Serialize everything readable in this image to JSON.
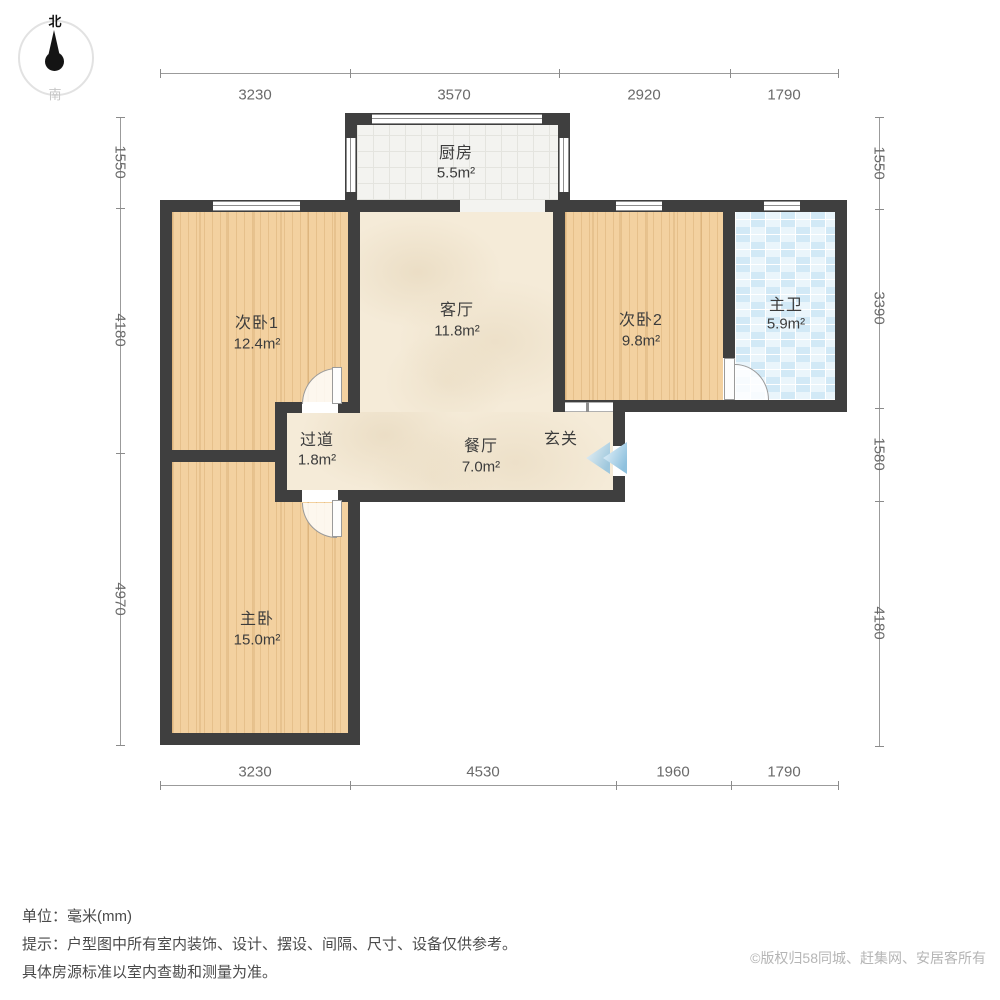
{
  "compass": {
    "north": "北",
    "south": "南"
  },
  "rooms": {
    "kitchen": {
      "name": "厨房",
      "area": "5.5m²"
    },
    "bedroom1": {
      "name": "次卧1",
      "area": "12.4m²"
    },
    "living": {
      "name": "客厅",
      "area": "11.8m²"
    },
    "bedroom2": {
      "name": "次卧2",
      "area": "9.8m²"
    },
    "bathroom": {
      "name": "主卫",
      "area": "5.9m²"
    },
    "hallway": {
      "name": "过道",
      "area": "1.8m²"
    },
    "dining": {
      "name": "餐厅",
      "area": "7.0m²"
    },
    "entry": {
      "name": "玄关"
    },
    "master": {
      "name": "主卧",
      "area": "15.0m²"
    }
  },
  "dimensions": {
    "top": [
      "3230",
      "3570",
      "2920",
      "1790"
    ],
    "bottom": [
      "3230",
      "4530",
      "1960",
      "1790"
    ],
    "left": [
      "1550",
      "4180",
      "4970"
    ],
    "right": [
      "1550",
      "3390",
      "1580",
      "4180"
    ]
  },
  "footer": {
    "unit": "单位：毫米(mm)",
    "tip_line1": "提示：户型图中所有室内装饰、设计、摆设、间隔、尺寸、设备仅供参考。",
    "tip_line2": "具体房源标准以室内查勘和测量为准。",
    "copyright": "©版权归58同城、赶集网、安居客所有"
  },
  "colors": {
    "wall": "#3f3f3f",
    "wood_floor": "#f3d1a0",
    "beige_floor": "#f5ebd8",
    "bath_tile": "#d2e9f6",
    "kitchen_tile": "#f3f3f0",
    "entry_arrow": "#8fc1de"
  }
}
